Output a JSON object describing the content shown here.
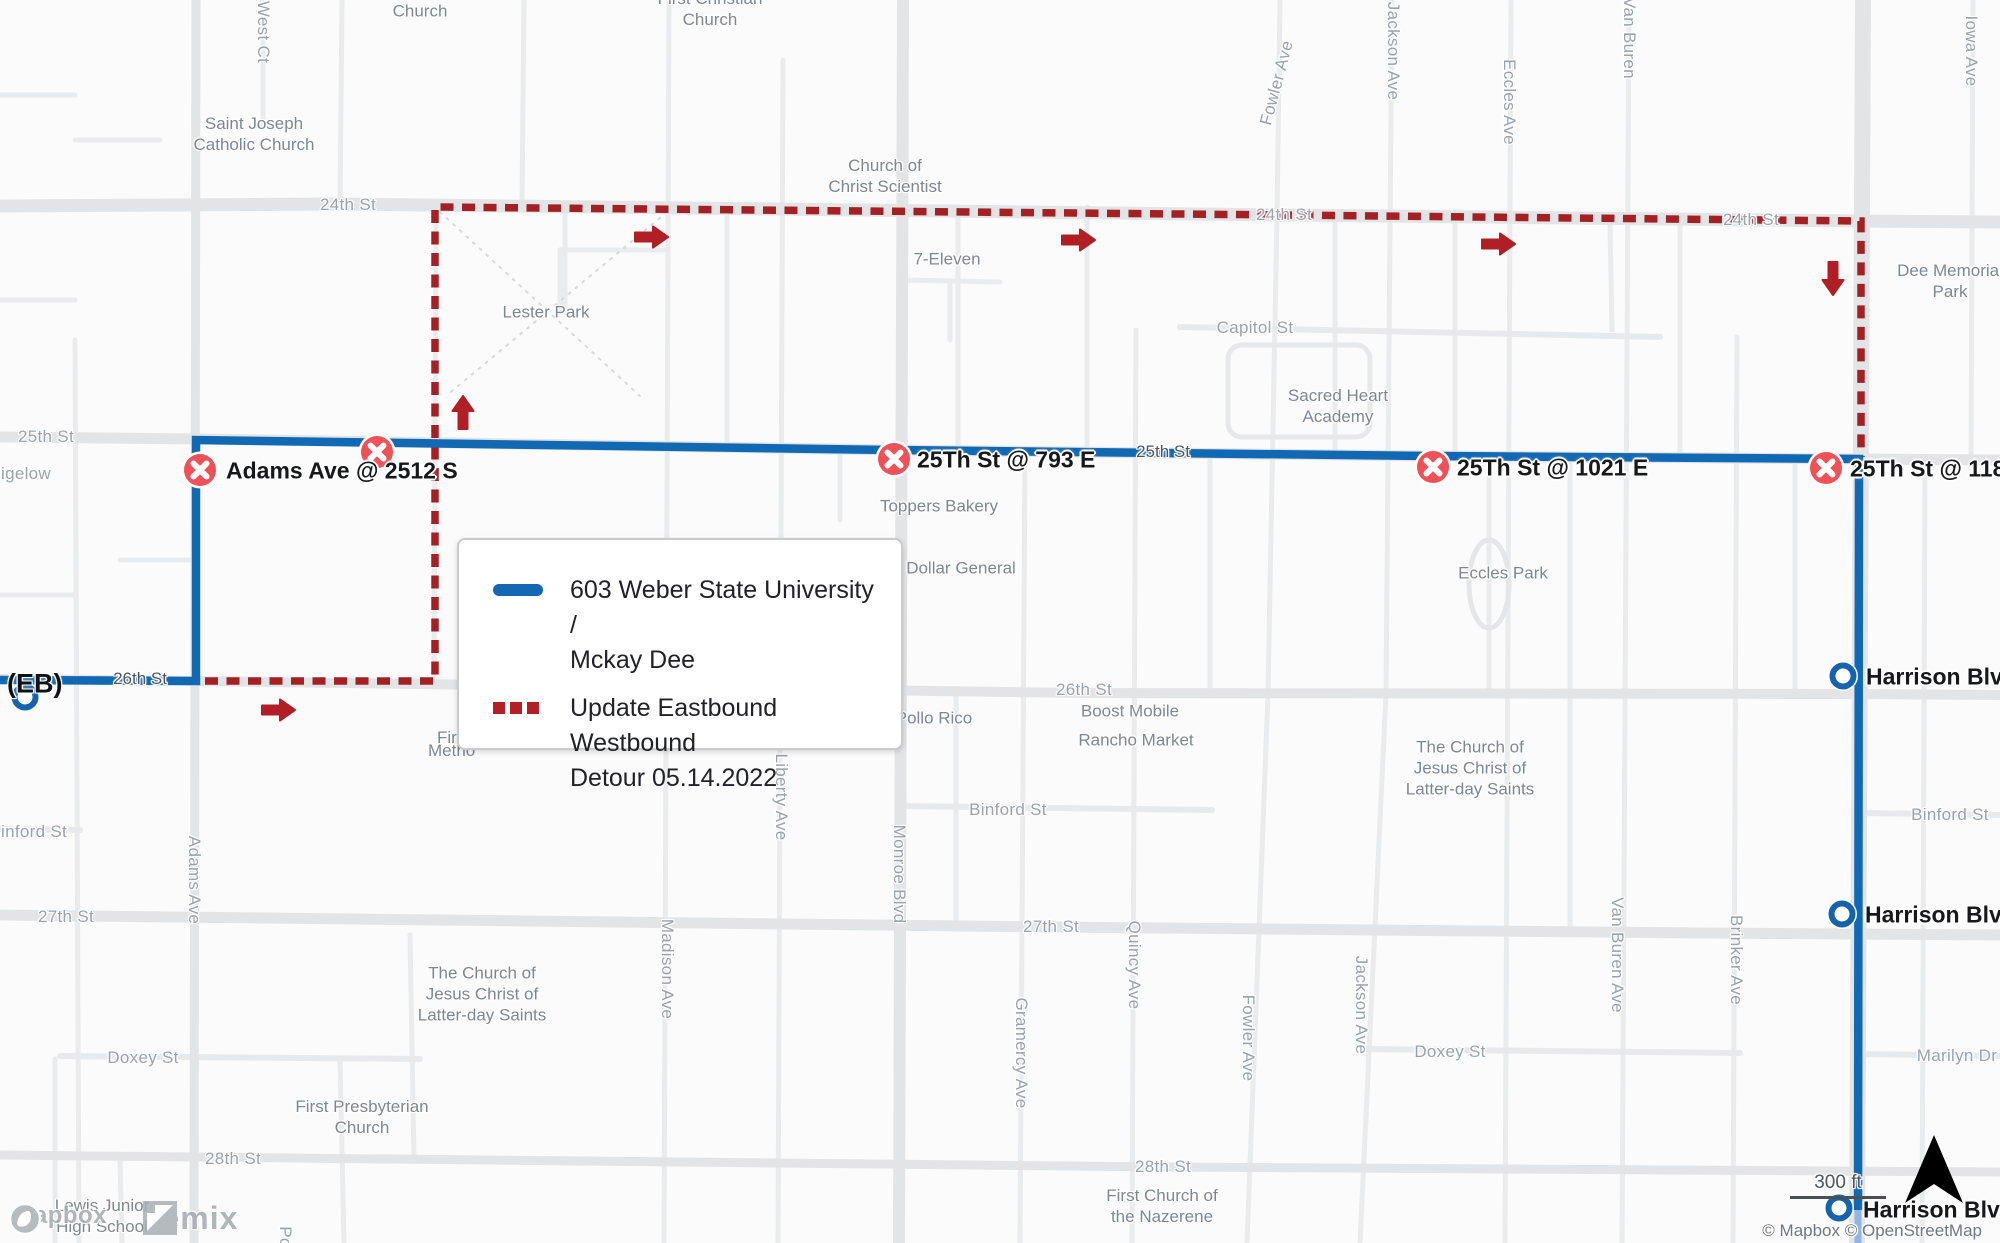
{
  "colors": {
    "route_blue": "#1168b3",
    "route_blue_faded": "#8fb6dd",
    "detour_red": "#a32025",
    "arrow_red": "#b01f25",
    "closed_stop_red": "#ee5157",
    "open_stop_blue": "#1563ab",
    "background": "#fbfbfb",
    "major_road": "#e2e4e6",
    "minor_road": "#e9ebec"
  },
  "legend": {
    "route": {
      "line1": "603 Weber State University /",
      "line2": "Mckay Dee"
    },
    "detour": {
      "line1": "Update Eastbound Westbound",
      "line2": "Detour 05.14.2022"
    }
  },
  "direction_label": "(EB)",
  "closed_stops": [
    {
      "label": "Adams Ave @ 2512 S"
    },
    {
      "label": ""
    },
    {
      "label": "25Th St @ 793 E"
    },
    {
      "label": "25Th St @ 1021 E"
    },
    {
      "label": "25Th St @ 118"
    }
  ],
  "open_stops": [
    {
      "label": ""
    },
    {
      "label": "Harrison Blvd"
    },
    {
      "label": "Harrison Blvd"
    },
    {
      "label": "Harrison Blvd"
    }
  ],
  "street_labels": [
    {
      "t": "25th St"
    },
    {
      "t": "igelow"
    },
    {
      "t": "24th St"
    },
    {
      "t": "24th St"
    },
    {
      "t": "24th St"
    },
    {
      "t": "25th St"
    },
    {
      "t": "26th St"
    },
    {
      "t": "26th St"
    },
    {
      "t": "inford St"
    },
    {
      "t": "Binford St"
    },
    {
      "t": "Binford St"
    },
    {
      "t": "27th St"
    },
    {
      "t": "27th St"
    },
    {
      "t": "Doxey St"
    },
    {
      "t": "Doxey St"
    },
    {
      "t": "Marilyn Dr"
    },
    {
      "t": "28th St"
    },
    {
      "t": "28th St"
    },
    {
      "t": "Capitol St"
    },
    {
      "t": "West Ct"
    },
    {
      "t": "Adams Ave"
    },
    {
      "t": "Madison Ave"
    },
    {
      "t": "Liberty Ave"
    },
    {
      "t": "Monroe Blvd"
    },
    {
      "t": "Gramercy Ave"
    },
    {
      "t": "Quincy Ave"
    },
    {
      "t": "Fowler Ave"
    },
    {
      "t": "Fowler Ave"
    },
    {
      "t": "Jackson Ave"
    },
    {
      "t": "Jackson Ave"
    },
    {
      "t": "Eccles Ave"
    },
    {
      "t": "Van Buren"
    },
    {
      "t": "Van Buren Ave"
    },
    {
      "t": "Brinker Ave"
    },
    {
      "t": "Iowa Ave"
    },
    {
      "t": "Po"
    },
    {
      "t": "Fir"
    },
    {
      "t": "Metho"
    }
  ],
  "poi_labels": [
    {
      "l1": "Church"
    },
    {
      "l1": "First Christian",
      "l2": "Church"
    },
    {
      "l1": "Saint Joseph",
      "l2": "Catholic Church"
    },
    {
      "l1": "Church of",
      "l2": "Christ Scientist"
    },
    {
      "l1": "7-Eleven"
    },
    {
      "l1": "Lester Park"
    },
    {
      "l1": "Sacred Heart",
      "l2": "Academy"
    },
    {
      "l1": "Dee Memorial",
      "l2": "Park"
    },
    {
      "l1": "Toppers Bakery"
    },
    {
      "l1": "Dollar General"
    },
    {
      "l1": "Eccles Park"
    },
    {
      "l1": "Pollo Rico"
    },
    {
      "l1": "Boost Mobile"
    },
    {
      "l1": "Rancho Market"
    },
    {
      "l1": "The Church of",
      "l2": "Jesus Christ of",
      "l3": "Latter-day Saints"
    },
    {
      "l1": "The Church of",
      "l2": "Jesus Christ of",
      "l3": "Latter-day Saints"
    },
    {
      "l1": "First Presbyterian",
      "l2": "Church"
    },
    {
      "l1": "First Church of",
      "l2": "the Nazerene"
    },
    {
      "l1": "Lewis Junior",
      "l2": "High School"
    }
  ],
  "watermark": {
    "mapbox": "mapbox",
    "remix": "remix"
  },
  "scale_text": "300 ft",
  "attribution": "© Mapbox © OpenStreetMap"
}
